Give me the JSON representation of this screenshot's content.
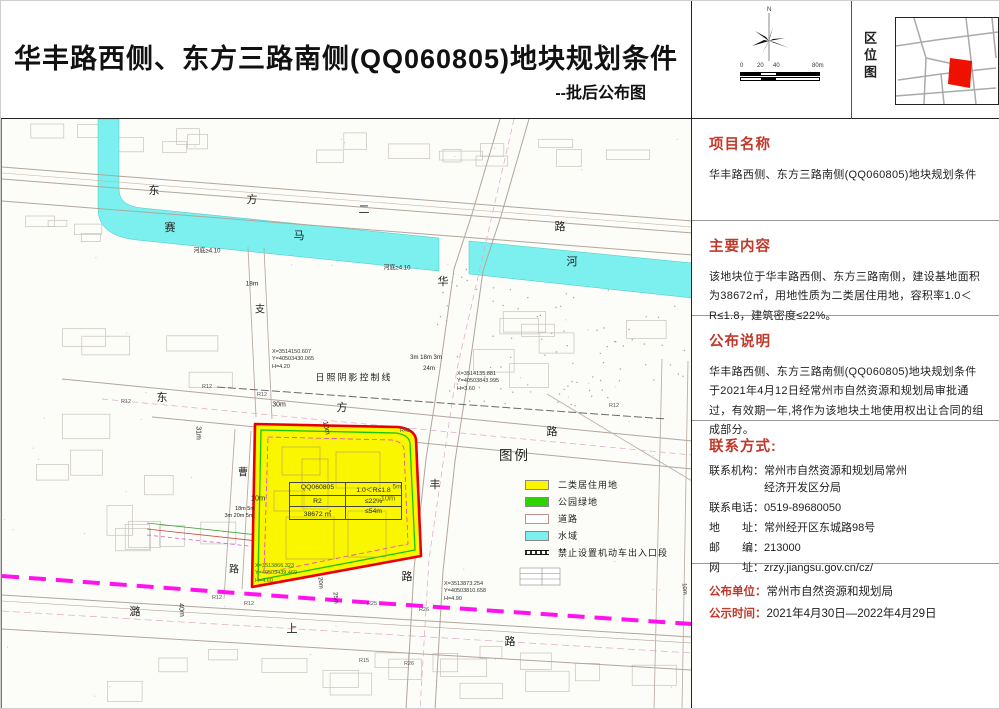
{
  "header": {
    "title": "华丰路西侧、东方三路南侧(QQ060805)地块规划条件",
    "subtitle": "--批后公布图",
    "north_label": "N",
    "scale_labels": [
      "0",
      "20",
      "40",
      "80m"
    ],
    "location_map_label": "区位图"
  },
  "sidebar": {
    "project": {
      "heading": "项目名称",
      "body": "华丰路西侧、东方三路南侧(QQ060805)地块规划条件"
    },
    "content": {
      "heading": "主要内容",
      "body": "该地块位于华丰路西侧、东方三路南侧，建设基地面积为38672㎡，用地性质为二类居住用地，容积率1.0＜R≤1.8，建筑密度≤22%。"
    },
    "notice": {
      "heading": "公布说明",
      "body": "华丰路西侧、东方三路南侧(QQ060805)地块规划条件 于2021年4月12日经常州市自然资源和规划局审批通过，有效期一年,将作为该地块土地使用权出让合同的组成部分。"
    },
    "contact": {
      "heading": "联系方式:",
      "rows": [
        {
          "label": "联系机构：",
          "value": "常州市自然资源和规划局常州\n经济开发区分局"
        },
        {
          "label": "联系电话：",
          "value": "0519-89680050"
        },
        {
          "label": "地　　址：",
          "value": "常州经开区东城路98号"
        },
        {
          "label": "邮　　编：",
          "value": "213000"
        },
        {
          "label": "网　　址：",
          "value": "zrzy.jiangsu.gov.cn/cz/"
        }
      ]
    },
    "publisher": {
      "label": "公布单位：",
      "value": "常州市自然资源和规划局"
    },
    "period": {
      "label": "公示时间：",
      "value": "2021年4月30日—2022年4月29日"
    }
  },
  "map": {
    "legend": {
      "title": "图例",
      "items": [
        {
          "swatch": "residential",
          "label": "二类居住用地"
        },
        {
          "swatch": "green",
          "label": "公园绿地"
        },
        {
          "swatch": "road",
          "label": "道路"
        },
        {
          "swatch": "water",
          "label": "水域"
        },
        {
          "swatch": "noaccess",
          "label": "禁止设置机动车出入口段"
        }
      ]
    },
    "parcel_table": {
      "rows": [
        [
          "QQ060805",
          "1.0＜R≤1.8"
        ],
        [
          "R2",
          "≤22%"
        ],
        [
          "38672 ㎡",
          "≤54m"
        ]
      ]
    },
    "labels": [
      {
        "text": "东",
        "x": 152,
        "y": 71,
        "s": 11
      },
      {
        "text": "方",
        "x": 250,
        "y": 80,
        "s": 11
      },
      {
        "text": "二",
        "x": 362,
        "y": 90,
        "s": 11
      },
      {
        "text": "路",
        "x": 558,
        "y": 107,
        "s": 11
      },
      {
        "text": "赛",
        "x": 168,
        "y": 108,
        "s": 11
      },
      {
        "text": "马",
        "x": 297,
        "y": 116,
        "s": 11
      },
      {
        "text": "河",
        "x": 570,
        "y": 142,
        "s": 11
      },
      {
        "text": "东",
        "x": 160,
        "y": 278,
        "s": 11
      },
      {
        "text": "方",
        "x": 340,
        "y": 288,
        "s": 11
      },
      {
        "text": "路",
        "x": 550,
        "y": 312,
        "s": 11
      },
      {
        "text": "华",
        "x": 441,
        "y": 162,
        "s": 11
      },
      {
        "text": "丰",
        "x": 433,
        "y": 365,
        "s": 11
      },
      {
        "text": "路",
        "x": 405,
        "y": 457,
        "s": 11
      },
      {
        "text": "支",
        "x": 258,
        "y": 189,
        "s": 10
      },
      {
        "text": "曹",
        "x": 241,
        "y": 352,
        "s": 10
      },
      {
        "text": "路",
        "x": 232,
        "y": 449,
        "s": 10
      },
      {
        "text": "潞",
        "x": 133,
        "y": 492,
        "s": 11
      },
      {
        "text": "上",
        "x": 290,
        "y": 509,
        "s": 11
      },
      {
        "text": "路",
        "x": 508,
        "y": 522,
        "s": 11
      },
      {
        "text": "河底≥4.10",
        "x": 205,
        "y": 131,
        "s": 6
      },
      {
        "text": "河底≥4.10",
        "x": 395,
        "y": 148,
        "s": 6
      },
      {
        "text": "18m",
        "x": 250,
        "y": 165,
        "s": 6.5
      },
      {
        "text": "30m",
        "x": 277,
        "y": 286,
        "s": 7
      },
      {
        "text": "31m",
        "x": 196,
        "y": 314,
        "s": 7,
        "r": 90
      },
      {
        "text": "3m 18m 3m",
        "x": 424,
        "y": 239,
        "s": 6
      },
      {
        "text": "24m",
        "x": 427,
        "y": 250,
        "s": 6
      },
      {
        "text": "10m",
        "x": 324,
        "y": 309,
        "s": 7,
        "r": 78
      },
      {
        "text": "10m",
        "x": 256,
        "y": 379,
        "s": 7.5
      },
      {
        "text": "10m",
        "x": 386,
        "y": 379,
        "s": 7.5
      },
      {
        "text": "5m",
        "x": 395,
        "y": 368,
        "s": 6.5
      },
      {
        "text": "18m 5m",
        "x": 243,
        "y": 390,
        "s": 5.5
      },
      {
        "text": "3m 20m 5m",
        "x": 237,
        "y": 397,
        "s": 5.5
      },
      {
        "text": "20m",
        "x": 318,
        "y": 464,
        "s": 6,
        "r": 85
      },
      {
        "text": "25m",
        "x": 333,
        "y": 479,
        "s": 6,
        "r": 85
      },
      {
        "text": "40m",
        "x": 179,
        "y": 491,
        "s": 7,
        "r": 85
      },
      {
        "text": "10m",
        "x": 682,
        "y": 470,
        "s": 6,
        "r": 85
      },
      {
        "text": "日照阴影控制线",
        "x": 352,
        "y": 258,
        "s": 9,
        "ls": 2
      },
      {
        "text": "R12",
        "x": 205,
        "y": 268,
        "s": 5.5,
        "c": "#555"
      },
      {
        "text": "R12",
        "x": 260,
        "y": 276,
        "s": 5.5,
        "c": "#555"
      },
      {
        "text": "R12",
        "x": 124,
        "y": 283,
        "s": 5.5,
        "c": "#555"
      },
      {
        "text": "R12",
        "x": 612,
        "y": 287,
        "s": 5.5,
        "c": "#555"
      },
      {
        "text": "R42",
        "x": 403,
        "y": 312,
        "s": 5.5,
        "c": "#555"
      },
      {
        "text": "R12",
        "x": 215,
        "y": 479,
        "s": 5.5,
        "c": "#555"
      },
      {
        "text": "R12",
        "x": 247,
        "y": 485,
        "s": 5.5,
        "c": "#555"
      },
      {
        "text": "R25",
        "x": 370,
        "y": 485,
        "s": 5.5,
        "c": "#555"
      },
      {
        "text": "R26",
        "x": 422,
        "y": 491,
        "s": 5.5,
        "c": "#555"
      },
      {
        "text": "R15",
        "x": 362,
        "y": 542,
        "s": 5.5,
        "c": "#555"
      },
      {
        "text": "R26",
        "x": 407,
        "y": 545,
        "s": 5.5,
        "c": "#555"
      },
      {
        "text": "X=3514150.607\nY=40503430.065\nH=4.20",
        "x": 270,
        "y": 230,
        "s": 5.5,
        "block": true
      },
      {
        "text": "X=3514135.881\nY=40503843.995\nH=3.60",
        "x": 455,
        "y": 252,
        "s": 5.5,
        "block": true
      },
      {
        "text": "X=3513866.323\nY=40503439.469\nH=4.60",
        "x": 253,
        "y": 444,
        "s": 5.5,
        "block": true,
        "c": "#2f6b1e"
      },
      {
        "text": "X=3513873.254\nY=40503810.658\nH=4.90",
        "x": 442,
        "y": 462,
        "s": 5.5,
        "block": true
      }
    ]
  },
  "colors": {
    "accent_red": "#c0392b",
    "parcel_fill": "#faf600",
    "parcel_border": "#e80000",
    "water": "#7bf0ee",
    "park_green": "#2ed400",
    "corridor_magenta": "#ff12ee",
    "site_red": "#ee1100"
  }
}
